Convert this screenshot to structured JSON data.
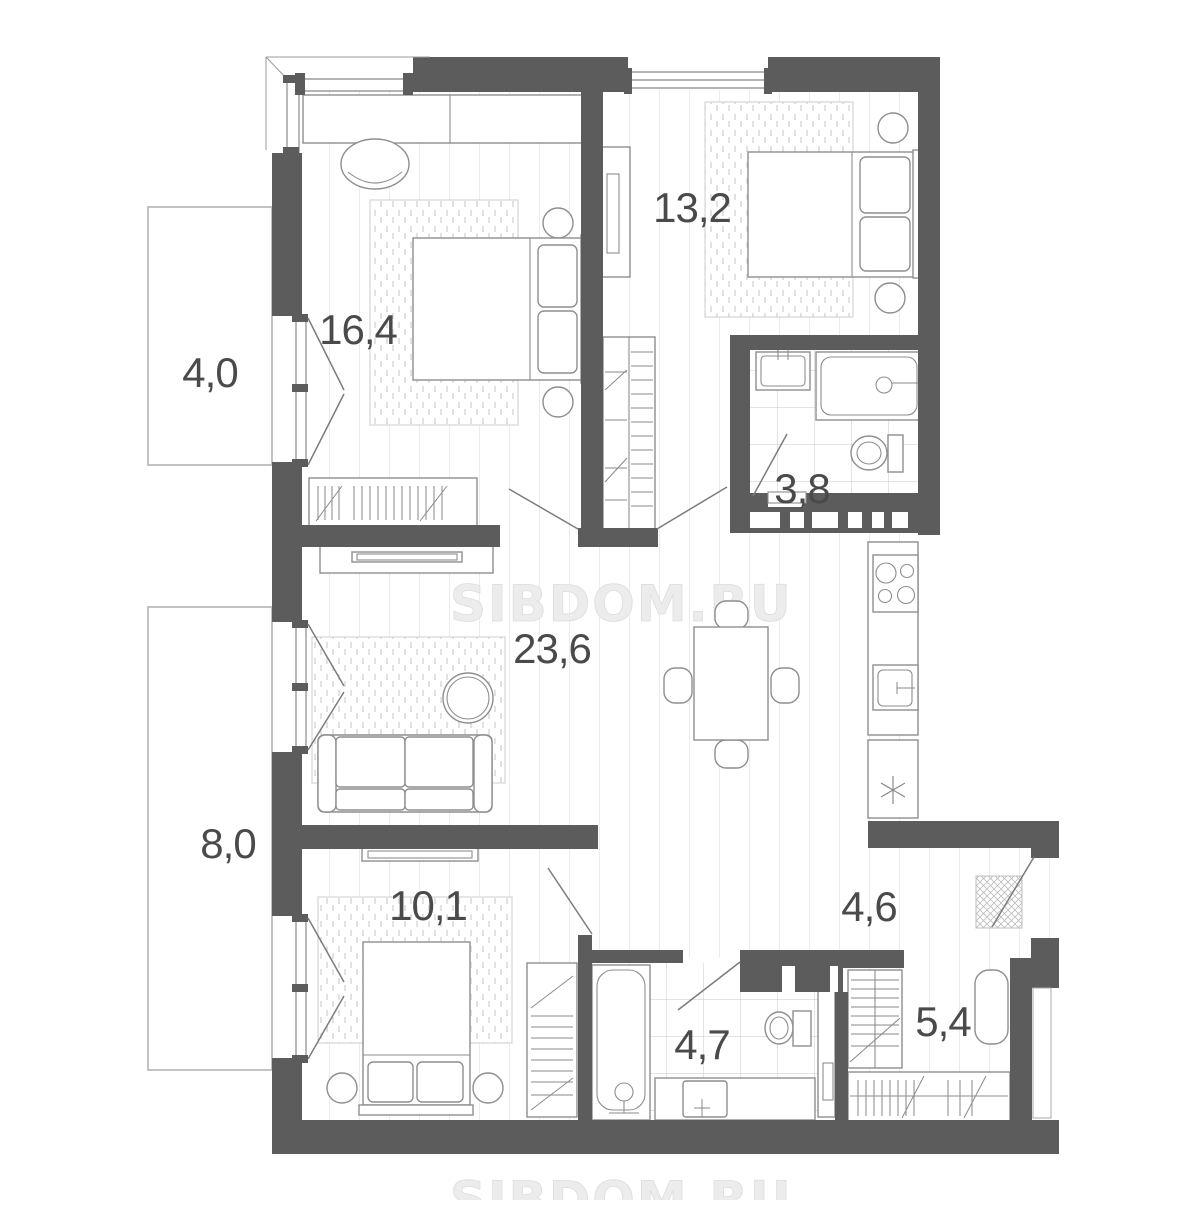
{
  "watermark": "SIBDOM.RU",
  "colors": {
    "wall": "#5c5c5c",
    "furniture_line": "#8e8e8e",
    "label_text": "#4a4a4a",
    "watermark_text": "#ececec",
    "plank_line": "#ececec",
    "tile_line": "#c8c8c8",
    "rug_dash": "#d6d6d6",
    "balcony_outline": "#b3b3b3"
  },
  "rooms": {
    "bedroom_main": {
      "area_m2": "16,4"
    },
    "bedroom_second": {
      "area_m2": "13,2"
    },
    "bathroom_small": {
      "area_m2": "3,8"
    },
    "living_kitchen": {
      "area_m2": "23,6"
    },
    "balcony_top": {
      "area_m2": "4,0"
    },
    "balcony_bottom": {
      "area_m2": "8,0"
    },
    "bedroom_third": {
      "area_m2": "10,1"
    },
    "hall": {
      "area_m2": "4,6"
    },
    "bathroom_main": {
      "area_m2": "4,7"
    },
    "wardrobe_room": {
      "area_m2": "5,4"
    }
  }
}
